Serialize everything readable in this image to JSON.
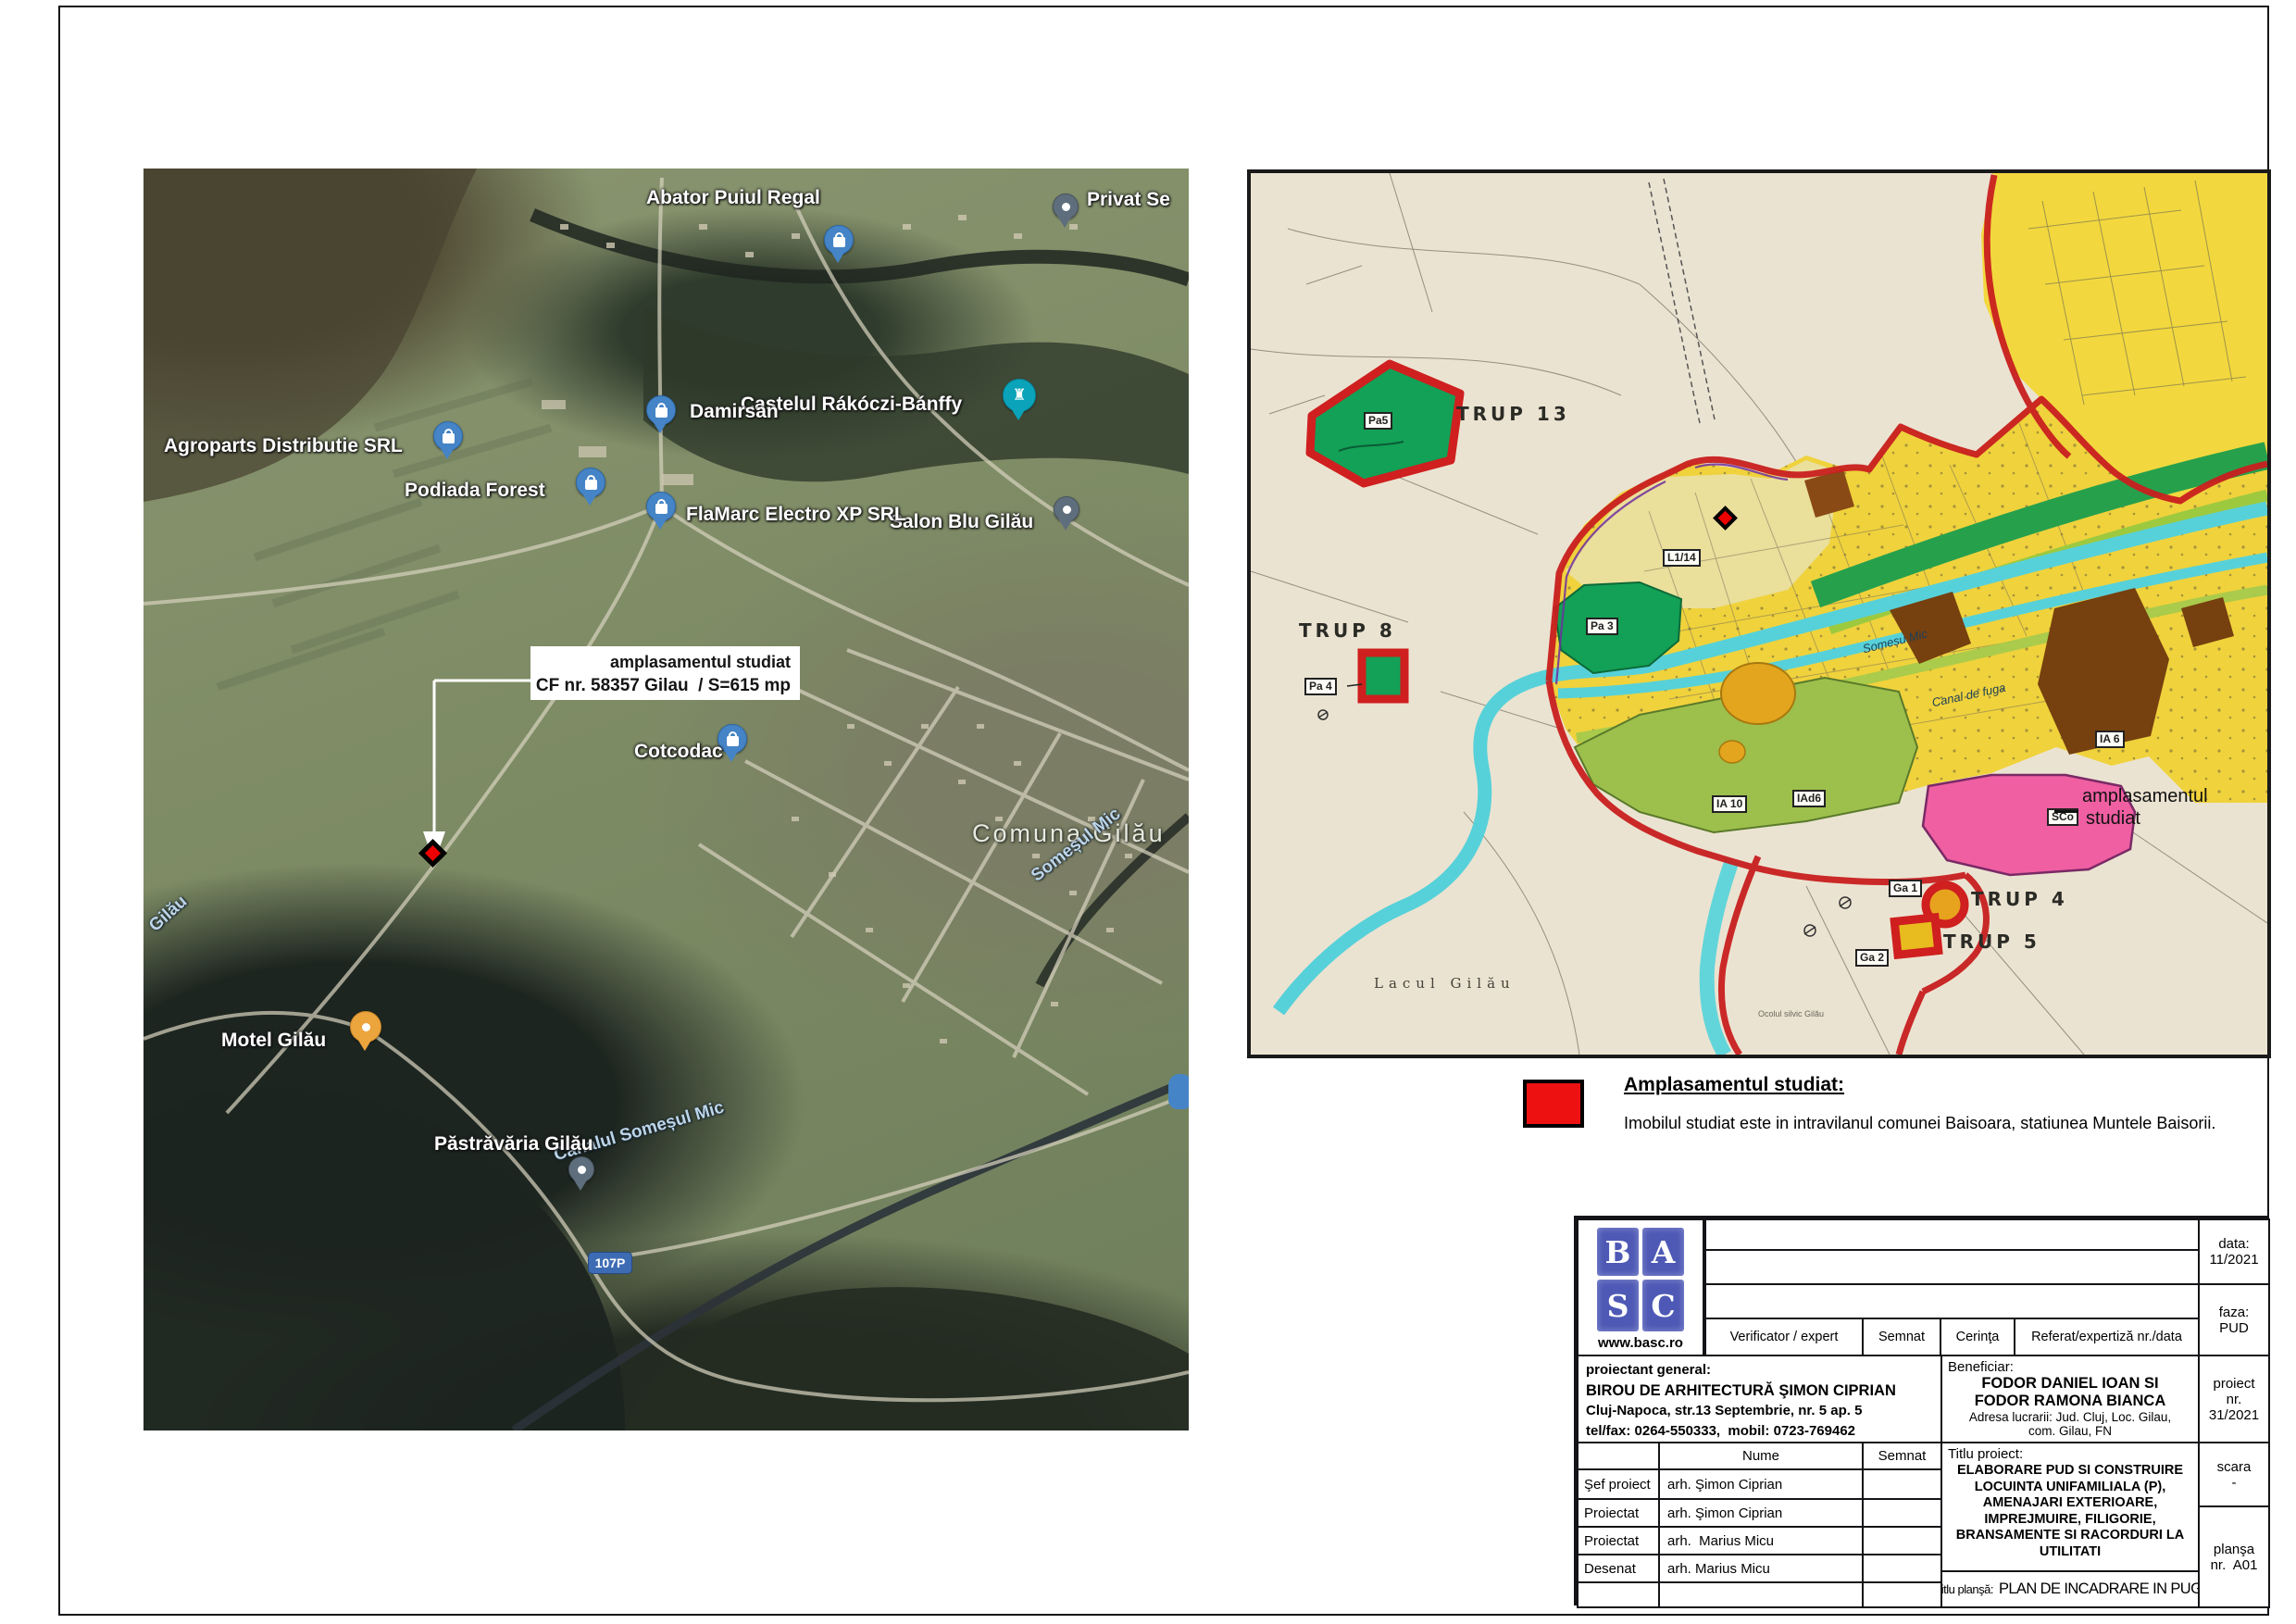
{
  "sat": {
    "annotation_line1": "amplasamentul studiat",
    "annotation_line2": "CF nr. 58357 Gilau  / S=615 mp",
    "labels": {
      "abator": "Abator Puiul Regal",
      "privat": "Privat Se",
      "castelul": "Castelul Rákóczi-Bánffy",
      "podiada": "Podiada Forest",
      "damirsan": "Damirsan",
      "agroparts": "Agroparts Distributie SRL",
      "salon": "Salon Blu Gilău",
      "flamarc": "FlaMarc Electro XP SRL",
      "cotcodac": "Cotcodac",
      "comuna": "Comuna Gilău",
      "somes": "Someșul Mic",
      "canal": "Canalul Someșul Mic",
      "motel": "Motel Gilău",
      "pastravaria": "Păstrăvăria Gilău",
      "gilau": "Gilău",
      "road107p": "107P"
    },
    "icons": {
      "castle_glyph": "♜"
    }
  },
  "pug": {
    "trup13": "TRUP 13",
    "trup8": "TRUP 8",
    "trup4": "TRUP 4",
    "trup5": "TRUP 5",
    "pa5": "Pa5",
    "pa4": "Pa 4",
    "pa3": "Pa 3",
    "l114": "L1/14",
    "ia10": "IA 10",
    "iad6": "IAd6",
    "ia6": "IA 6",
    "sco": "SCo",
    "ga1": "Ga 1",
    "ga2": "Ga 2",
    "lacul": "Lacul Gilău",
    "somesu": "Someșu Mic",
    "canalfuga": "Canal de fuga",
    "ocolul": "Ocolul silvic Gilău",
    "ampl1": "amplasamentul",
    "ampl2": "studiat"
  },
  "legend": {
    "heading": "Amplasamentul studiat:",
    "body": "Imobilul studiat este in intravilanul comunei Baisoara, statiunea Muntele Baisorii.",
    "swatch_color": "#ee1111"
  },
  "titleblock": {
    "logo": {
      "l1": "B",
      "l2": "A",
      "l3": "S",
      "l4": "C",
      "website": "www.basc.ro"
    },
    "verif_header": {
      "verificator": "Verificator / expert",
      "semnat": "Semnat",
      "cerinta": "Cerinţa",
      "referat": "Referat/expertiză nr./data"
    },
    "data_label": "data:",
    "data_value": "11/2021",
    "faza_label": "faza:",
    "faza_value": "PUD",
    "proiect_label": "proiect",
    "proiect_nr": "nr.",
    "proiect_value": "31/2021",
    "scara_label": "scara",
    "scara_value": "-",
    "plansa_label": "planşa",
    "plansa_value": "nr.  A01",
    "proiectant": {
      "label": "proiectant general:",
      "name": "BIROU DE ARHITECTURĂ ŞIMON CIPRIAN",
      "address": "Cluj-Napoca, str.13 Septembrie, nr. 5 ap. 5",
      "phone": "tel/fax: 0264-550333,  mobil: 0723-769462"
    },
    "beneficiar": {
      "label": "Beneficiar:",
      "name1": "FODOR DANIEL IOAN SI",
      "name2": "FODOR RAMONA BIANCA",
      "addr1": "Adresa lucrarii: Jud. Cluj, Loc. Gilau,",
      "addr2": "com. Gilau, FN"
    },
    "team_header": {
      "nume": "Nume",
      "semnat": "Semnat"
    },
    "team": [
      {
        "role": "Şef proiect",
        "name": "arh. Şimon Ciprian"
      },
      {
        "role": "Proiectat",
        "name": "arh. Şimon Ciprian"
      },
      {
        "role": "Proiectat",
        "name": "arh.  Marius Micu"
      },
      {
        "role": "Desenat",
        "name": "arh. Marius Micu"
      }
    ],
    "titlu_proiect_label": "Titlu proiect:",
    "titlu_proiect_lines": [
      "ELABORARE PUD SI CONSTRUIRE",
      "LOCUINTA UNIFAMILIALA (P),",
      "AMENAJARI EXTERIOARE,",
      "IMPREJMUIRE, FILIGORIE,",
      "BRANSAMENTE SI RACORDURI LA",
      "UTILITATI"
    ],
    "titlu_plansa_label": "titlu planşă:",
    "titlu_plansa_value": "PLAN DE INCADRARE IN PUG"
  }
}
